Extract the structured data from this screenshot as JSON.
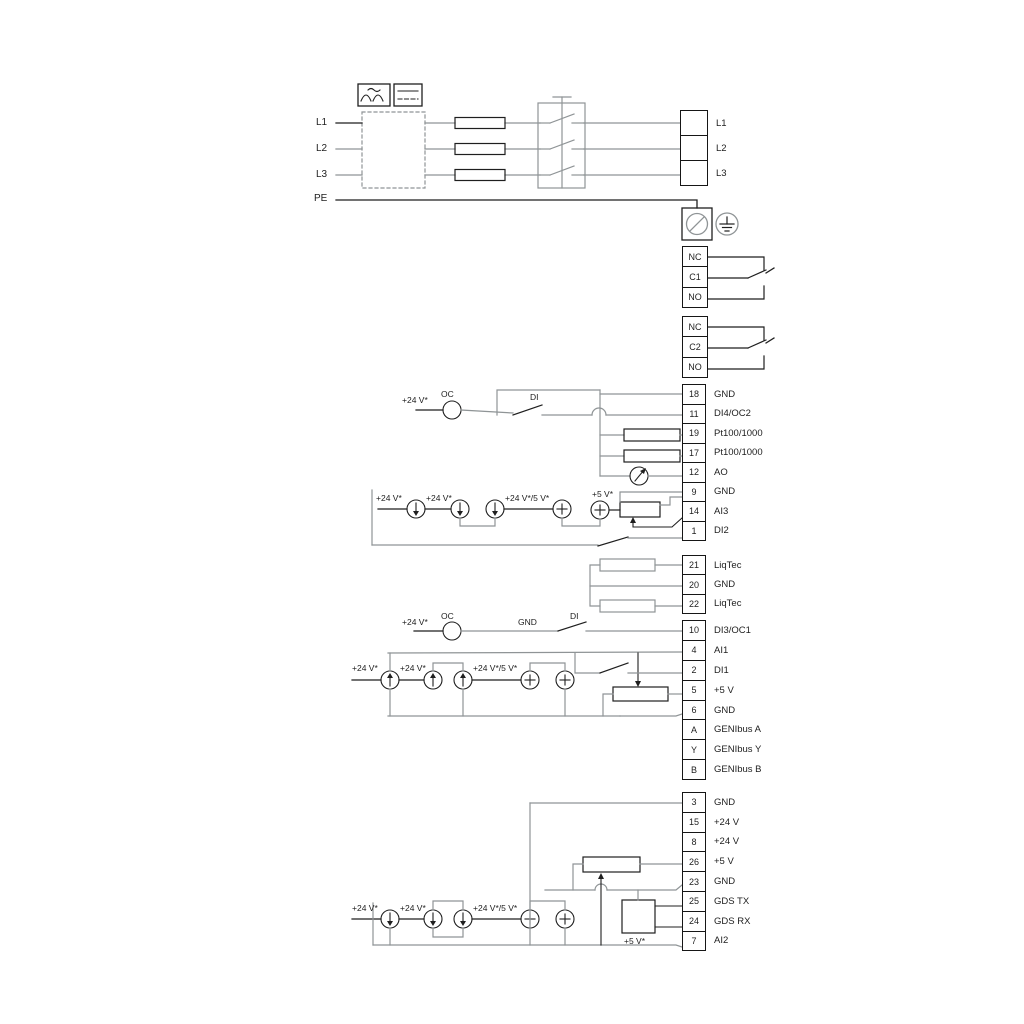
{
  "colors": {
    "wire_gray": "#8f9496",
    "wire_black": "#1f1f1f",
    "background": "#ffffff"
  },
  "power_input": {
    "l1": "L1",
    "l2": "L2",
    "l3": "L3",
    "pe": "PE"
  },
  "power_output": [
    {
      "label": "L1"
    },
    {
      "label": "L2"
    },
    {
      "label": "L3"
    }
  ],
  "relays": {
    "relay1": [
      {
        "label": "NC"
      },
      {
        "label": "C1"
      },
      {
        "label": "NO"
      }
    ],
    "relay2": [
      {
        "label": "NC"
      },
      {
        "label": "C2"
      },
      {
        "label": "NO"
      }
    ]
  },
  "blocks": {
    "a": [
      {
        "num": "18",
        "label": "GND"
      },
      {
        "num": "11",
        "label": "DI4/OC2"
      },
      {
        "num": "19",
        "label": "Pt100/1000"
      },
      {
        "num": "17",
        "label": "Pt100/1000"
      },
      {
        "num": "12",
        "label": "AO"
      },
      {
        "num": "9",
        "label": "GND"
      },
      {
        "num": "14",
        "label": "AI3"
      },
      {
        "num": "1",
        "label": "DI2"
      }
    ],
    "b": [
      {
        "num": "21",
        "label": "LiqTec"
      },
      {
        "num": "20",
        "label": "GND"
      },
      {
        "num": "22",
        "label": "LiqTec"
      }
    ],
    "c": [
      {
        "num": "10",
        "label": "DI3/OC1"
      },
      {
        "num": "4",
        "label": "AI1"
      },
      {
        "num": "2",
        "label": "DI1"
      },
      {
        "num": "5",
        "label": "+5 V"
      },
      {
        "num": "6",
        "label": "GND"
      },
      {
        "num": "A",
        "label": "GENIbus A"
      },
      {
        "num": "Y",
        "label": "GENIbus Y"
      },
      {
        "num": "B",
        "label": "GENIbus B"
      }
    ],
    "d": [
      {
        "num": "3",
        "label": "GND"
      },
      {
        "num": "15",
        "label": "+24 V"
      },
      {
        "num": "8",
        "label": "+24 V"
      },
      {
        "num": "26",
        "label": "+5 V"
      },
      {
        "num": "23",
        "label": "GND"
      },
      {
        "num": "25",
        "label": "GDS TX"
      },
      {
        "num": "24",
        "label": "GDS RX"
      },
      {
        "num": "7",
        "label": "AI2"
      }
    ]
  },
  "inline_labels": {
    "oc2_supply": "+24 V*",
    "oc2": "OC",
    "di2_box": "DI",
    "ai3_supply1": "+24 V*",
    "ai3_supply2": "+24 V*",
    "ai3_supply3": "+24 V*/5 V*",
    "ai3_5v": "+5 V*",
    "oc1_supply": "+24 V*",
    "oc1": "OC",
    "oc1_gnd": "GND",
    "oc1_di": "DI",
    "ai1_supply1": "+24 V*",
    "ai1_supply2": "+24 V*",
    "ai1_supply3": "+24 V*/5 V*",
    "ai2_supply1": "+24 V*",
    "ai2_supply2": "+24 V*",
    "ai2_supply3": "+24 V*/5 V*",
    "gds_5v": "+5 V*"
  },
  "icons": [
    "ac-waveform-icon",
    "dc-voltage-icon",
    "emc-filter-box",
    "fuse-icon",
    "contactor-icon",
    "pe-screw-terminal-icon",
    "protective-earth-icon",
    "relay-contact-icon",
    "current-source-icon",
    "voltage-source-icon",
    "meter-icon",
    "potentiometer-icon",
    "resistor-icon",
    "switch-icon",
    "gds-sensor-box"
  ]
}
